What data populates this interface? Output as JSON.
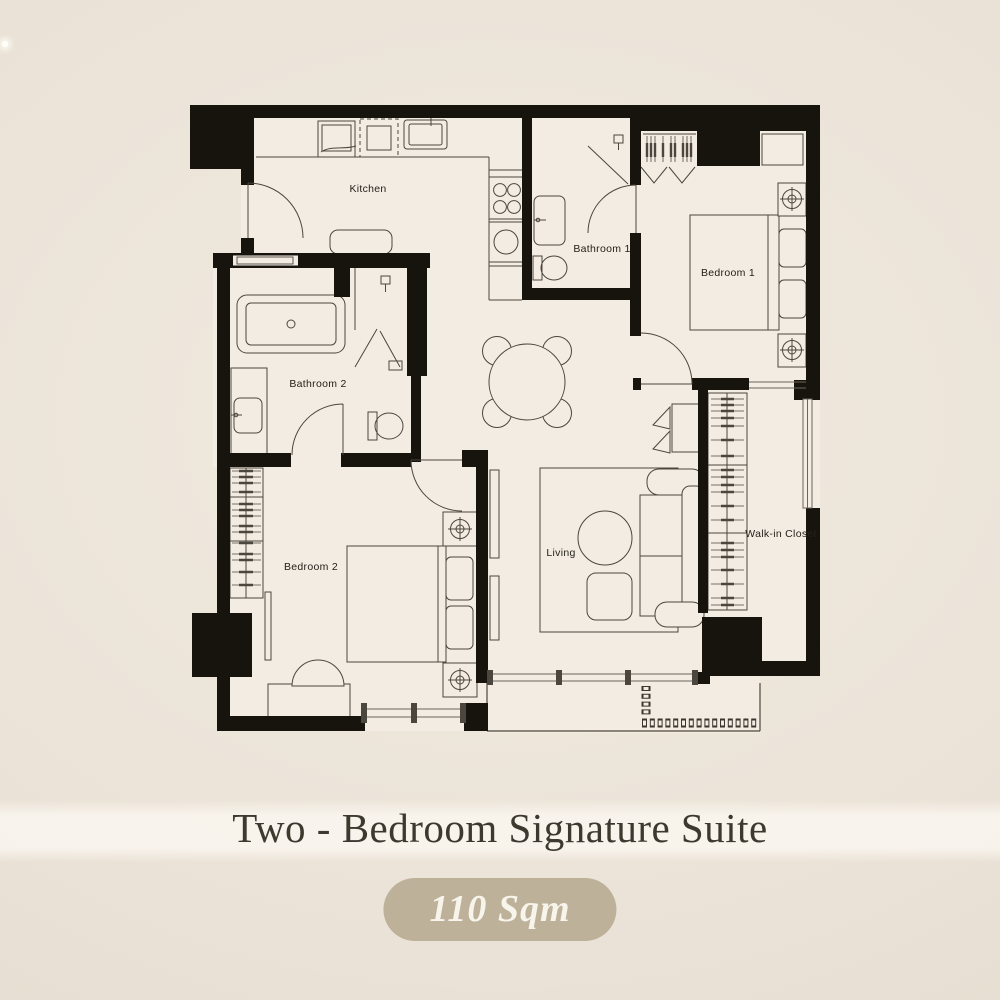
{
  "page": {
    "background_color": "#ebe3d8",
    "sparkle_color": "#ffffff"
  },
  "plan": {
    "colors": {
      "wall": "#17130d",
      "floor": "#f3ece2",
      "furniture_line": "#4b463e"
    },
    "rooms": [
      {
        "id": "kitchen",
        "label": "Kitchen"
      },
      {
        "id": "bathroom-1",
        "label": "Bathroom 1"
      },
      {
        "id": "bedroom-1",
        "label": "Bedroom 1"
      },
      {
        "id": "bathroom-2",
        "label": "Bathroom 2"
      },
      {
        "id": "bedroom-2",
        "label": "Bedroom 2"
      },
      {
        "id": "living",
        "label": "Living"
      },
      {
        "id": "walk-in-closet",
        "label": "Walk-in Closet"
      }
    ]
  },
  "caption": {
    "title": "Two - Bedroom Signature Suite",
    "title_color": "#3e392f",
    "area_badge": "110 Sqm",
    "badge_bg": "#bdb199",
    "badge_text_color": "#f7f4ec"
  }
}
